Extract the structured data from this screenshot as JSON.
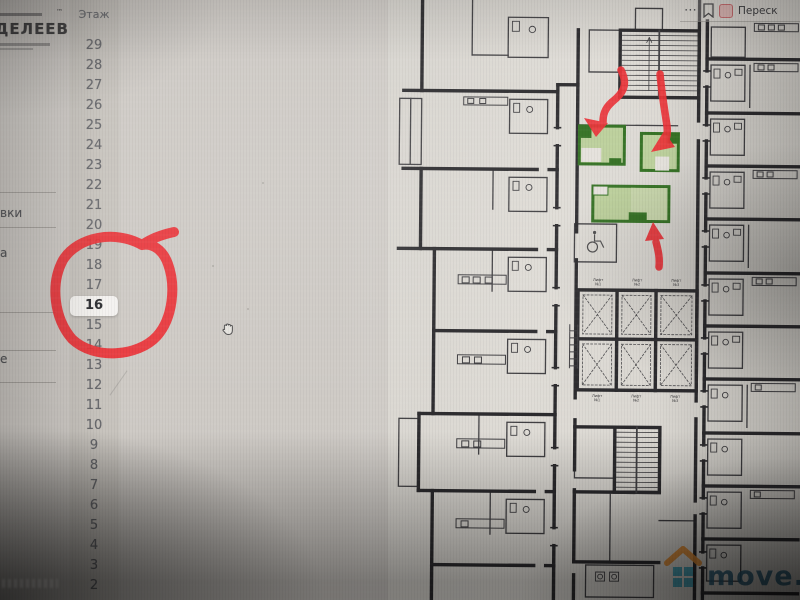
{
  "toolbar": {
    "more": "⋯",
    "summary_label": "Переск"
  },
  "logo": {
    "name": "ДЕЛЕЕВ",
    "tm": "™"
  },
  "filters": {
    "truncated": [
      "вки",
      "а",
      "е"
    ]
  },
  "floors": {
    "header": "Этаж",
    "selected": "16",
    "list": [
      "29",
      "28",
      "27",
      "26",
      "25",
      "24",
      "23",
      "22",
      "21",
      "20",
      "19",
      "18",
      "17",
      "16",
      "15",
      "14",
      "13",
      "12",
      "11",
      "10",
      "9",
      "8",
      "7",
      "6",
      "5",
      "4",
      "3",
      "2"
    ]
  },
  "plan": {
    "lifts": [
      {
        "line1": "Лифт",
        "line2": "№1"
      },
      {
        "line1": "Лифт",
        "line2": "№2"
      },
      {
        "line1": "Лифт",
        "line2": "№3"
      }
    ],
    "highlight_border": "#2c6e1d",
    "highlight_fill": "#bcd29c",
    "highlight_fill_alt": "#c8d8ac",
    "annotation_color": "#ee2a31",
    "wall_color": "#26262a"
  },
  "watermark": {
    "text": "move.ru",
    "roof_color": "#e08a2e",
    "window_color": "#2f9bb5",
    "text_color": "#215a77"
  }
}
